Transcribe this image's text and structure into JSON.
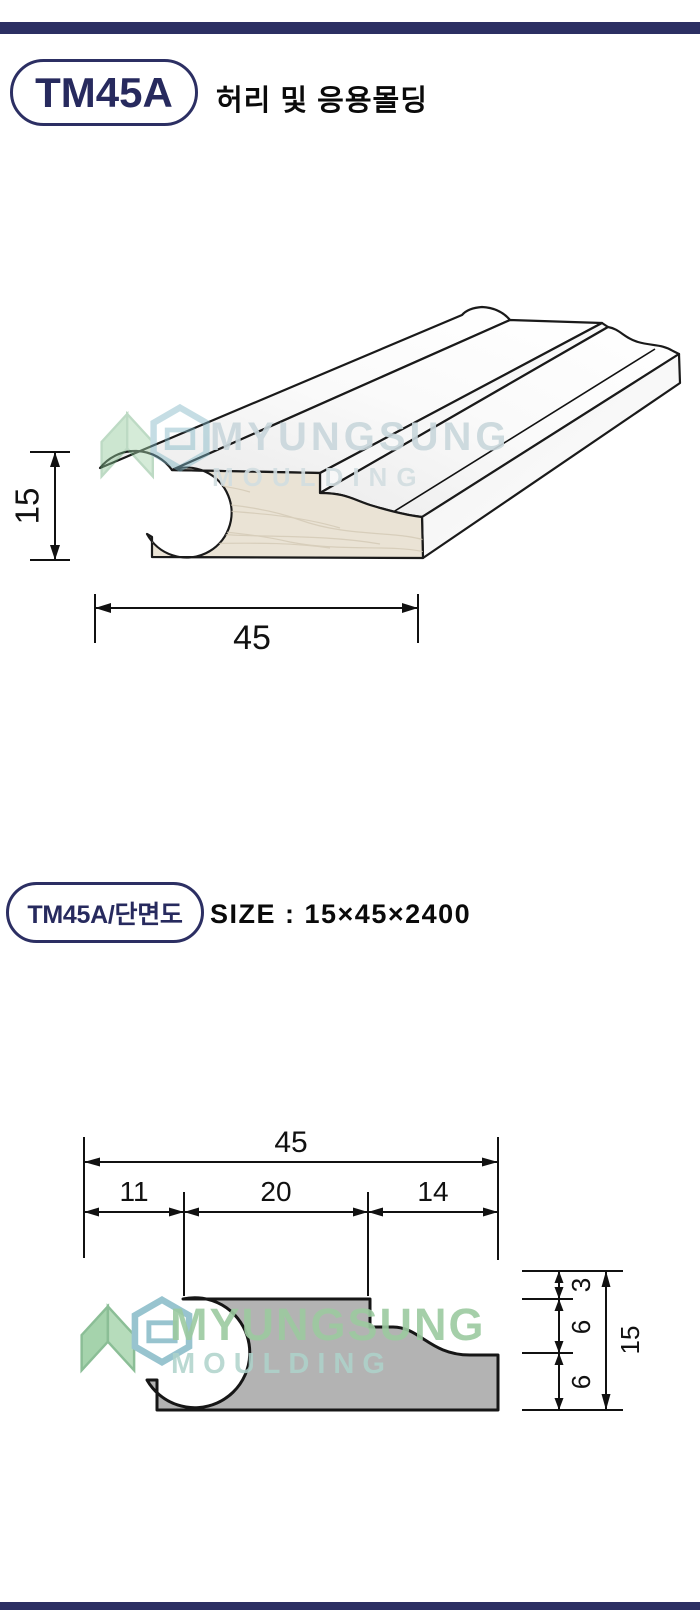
{
  "brand": {
    "name": "MYUNGSUNG",
    "sub": "MOULDING"
  },
  "colors": {
    "navy": "#2c2f63",
    "profile_gray": "#b3b3b3",
    "face_beige": "#eae3d5",
    "watermark_green": "#9ccaa0",
    "watermark_teal": "#7fb6c4"
  },
  "header1": {
    "code": "TM45A",
    "title": "허리 및 응용몰딩"
  },
  "header2": {
    "code": "TM45A/단면도",
    "size_text": "SIZE :  15×45×2400"
  },
  "perspective_view": {
    "height_label": "15",
    "width_label": "45"
  },
  "cross_section": {
    "total_width": "45",
    "top_segments": [
      "11",
      "20",
      "14"
    ],
    "right_segments": [
      "3",
      "6",
      "6"
    ],
    "total_height": "15"
  }
}
